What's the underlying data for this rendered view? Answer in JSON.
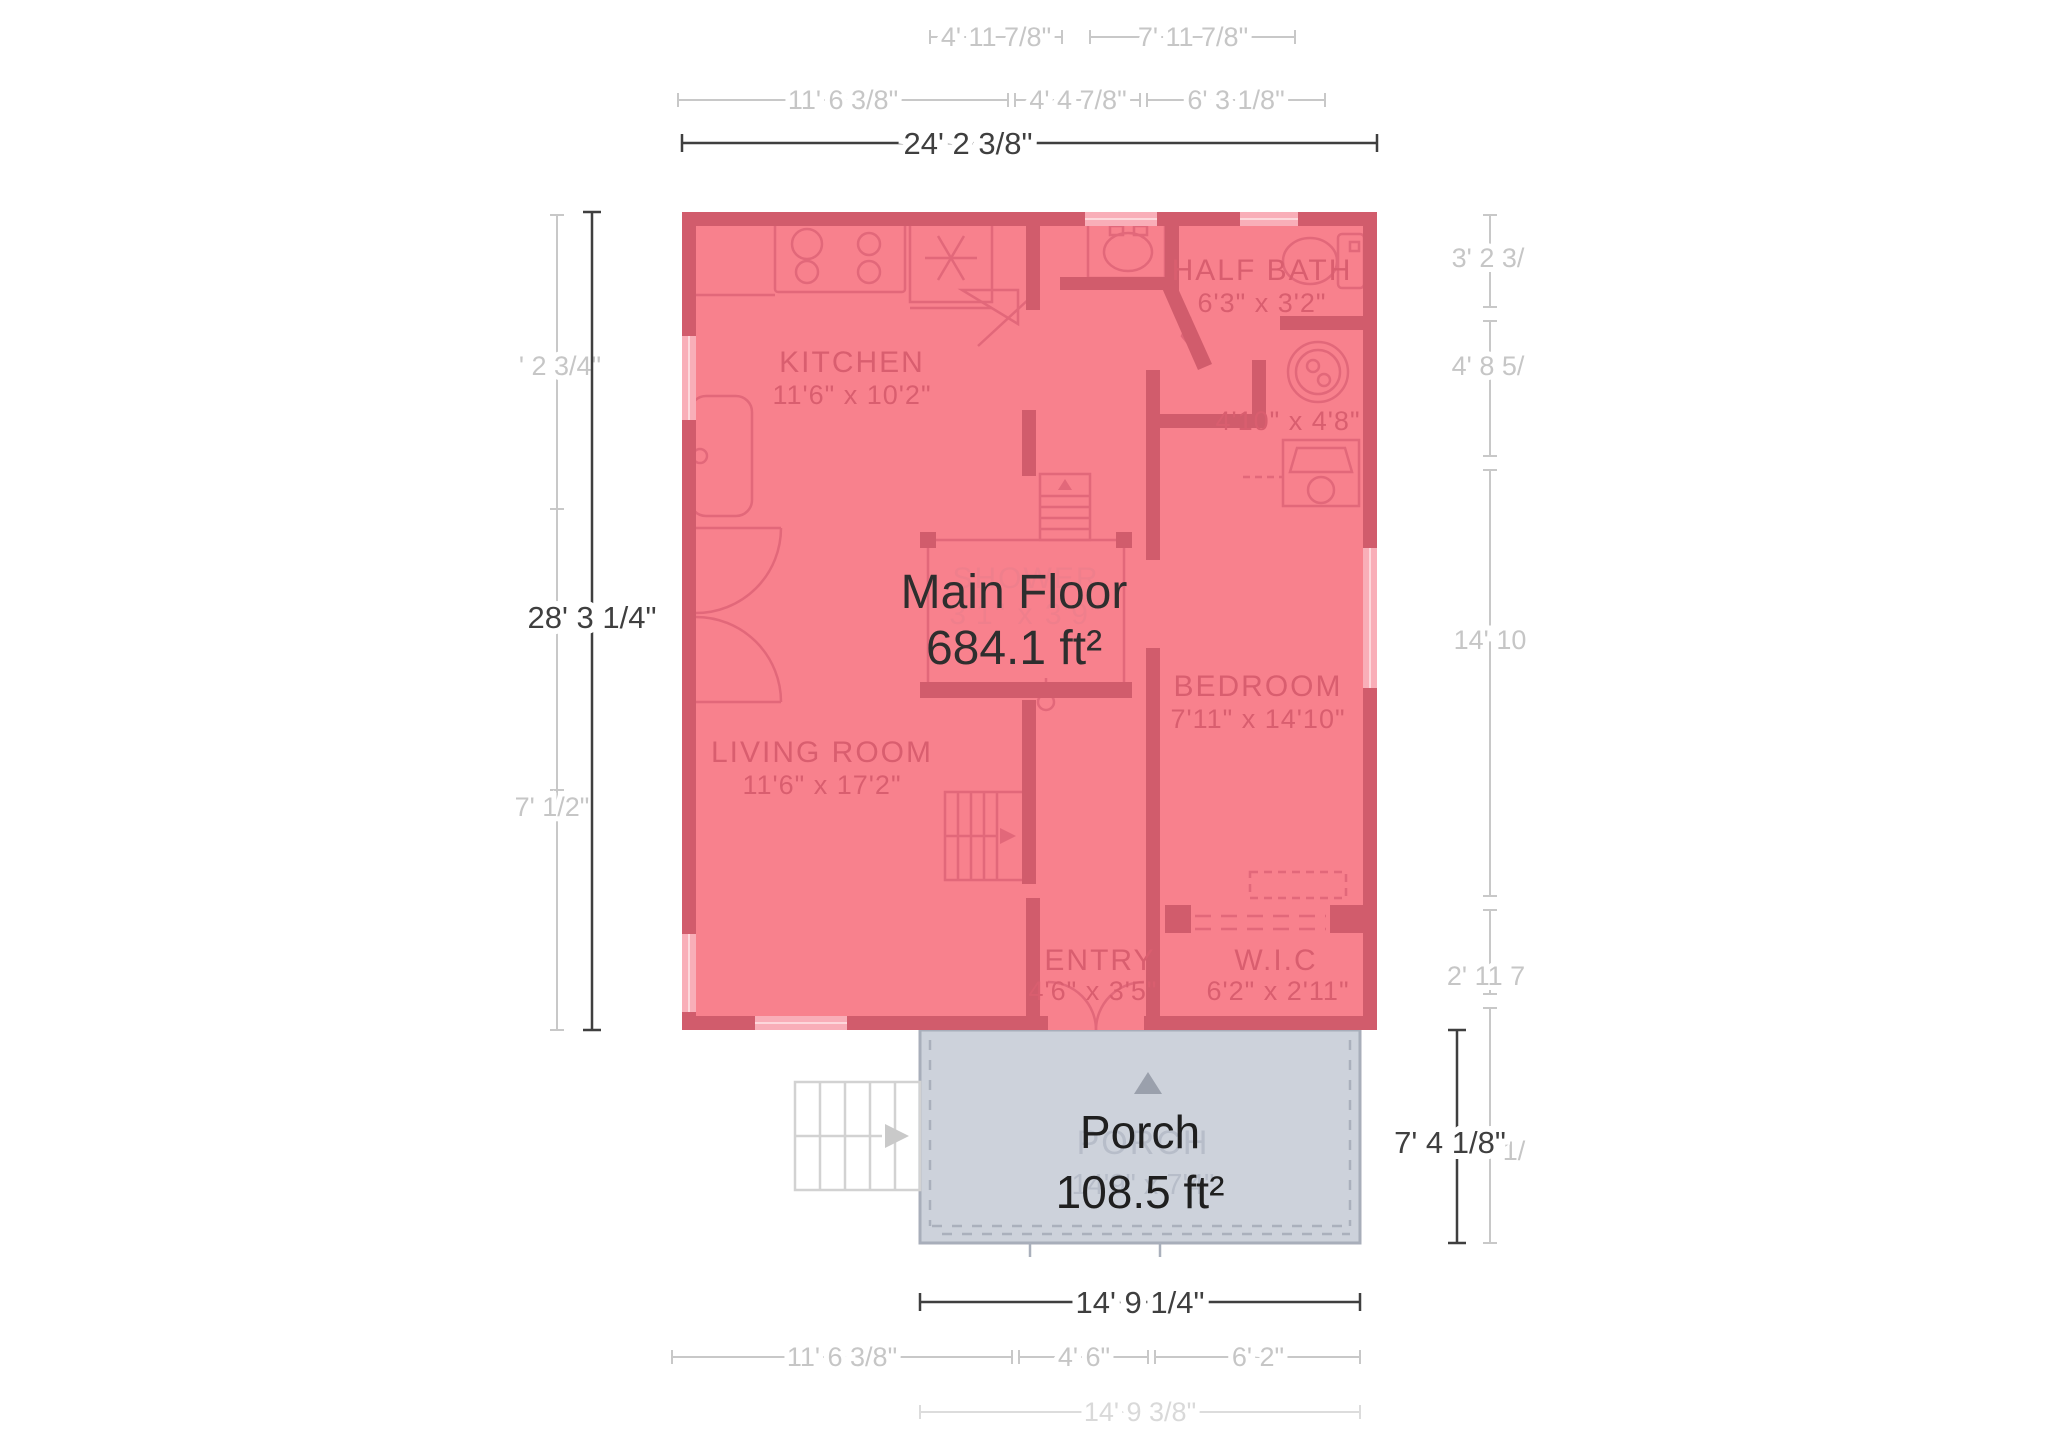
{
  "floor": {
    "label": "Main Floor",
    "area": "684.1 ft²",
    "rooms": {
      "kitchen": {
        "name": "KITCHEN",
        "dims": "11'6\" x 10'2\""
      },
      "half_bath": {
        "name": "HALF BATH",
        "dims": "6'3\" x 3'2\""
      },
      "laundry": {
        "dims": "4'10\" x 4'8\""
      },
      "bedroom": {
        "name": "BEDROOM",
        "dims": "7'11\" x 14'10\""
      },
      "living_room": {
        "name": "LIVING ROOM",
        "dims": "11'6\" x 17'2\""
      },
      "entry": {
        "name": "ENTRY",
        "dims": "4'6\" x 3'5\""
      },
      "wic": {
        "name": "W.I.C",
        "dims": "6'2\" x 2'11\""
      },
      "shower": {
        "name": "SHOWER",
        "dims": "3'1\" x 3'9\""
      }
    }
  },
  "porch": {
    "label": "Porch",
    "area": "108.5 ft²",
    "ghost_label": "PORCH",
    "ghost_dims": "14'9\" x 7'4\""
  },
  "dims": {
    "top1": [
      "4' 11 7/8\"",
      "7' 11 7/8\""
    ],
    "top2": [
      "11' 6 3/8\"",
      "4' 4 7/8\"",
      "6' 3 1/8\""
    ],
    "top_total": "24' 2 3/8\"",
    "left": [
      "' 2 3/4\"",
      "7' 1/2\""
    ],
    "left_total": "28' 3 1/4\"",
    "right": [
      "3' 2 3/",
      "4' 8 5/",
      "14' 10",
      "2' 11 7",
      "1/"
    ],
    "porch_height": "7' 4 1/8\"",
    "porch_width": "14' 9 1/4\"",
    "bottom2": [
      "11' 6 3/8\"",
      "4' 6\"",
      "6' 2\""
    ],
    "bottom_total": "14' 9 3/8\""
  },
  "colors": {
    "floor_fill": "#f8818d",
    "wall": "#d15c6c",
    "room_text": "#d95e6f",
    "porch_fill": "#cdd2db",
    "porch_border": "#a8aeba",
    "dark_text": "#2e2e2e",
    "dim_dark": "#3f3f3f",
    "dim_light": "#c8c8c8"
  }
}
